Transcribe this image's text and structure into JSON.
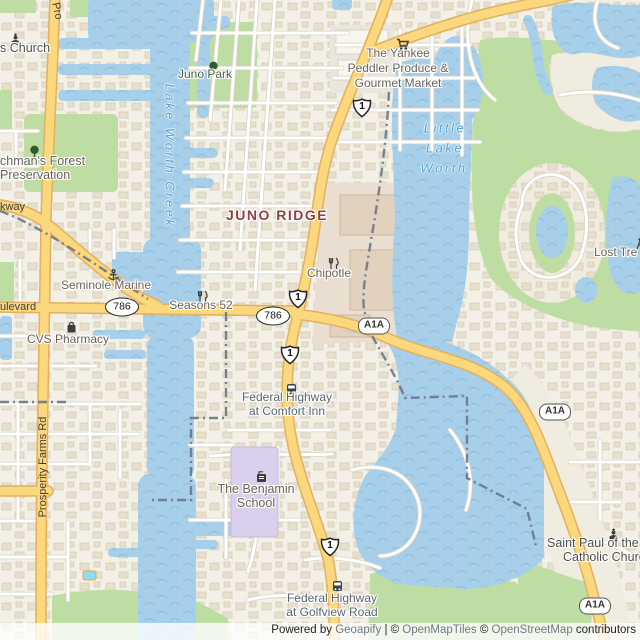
{
  "palette": {
    "land": "#f3f0e8",
    "residential_building": "#e6ddc9",
    "building_stroke": "#d2c7ae",
    "water": "#a8cfe9",
    "wave": "#90c1de",
    "green": "#bedda3",
    "road_main": "#fbd77d",
    "road_casing": "#e2b05e",
    "road_minor": "#ffffff",
    "road_minor_casing": "#d9d3c5",
    "boundary": "#6e7789",
    "district_label": "#8a4242",
    "water_label": "#4fa0cf",
    "poi_label": "#6b6157",
    "transit_label": "#5a646e",
    "road_label": "#3f3f3f",
    "school_fill": "#dad0eb",
    "commercial_fill": "#e9ded0",
    "plaza_fill": "#e9e6df",
    "attribution_link": "#6d7a85"
  },
  "routes": {
    "us1": "1",
    "sr786": "786",
    "a1a": "A1A"
  },
  "labels": {
    "s_church": "s Church",
    "juno_park": "Juno Park",
    "yankee1": "The Yankee",
    "yankee2": "Peddler Produce &",
    "yankee3": "Gourmet Market",
    "creek": "Lake Worth Creek",
    "little1": "Little",
    "little2": "Lake",
    "little3": "Worth",
    "forest1": "chman's Forest",
    "forest2": "Preservation",
    "parkway": "kway",
    "juno_ridge": "JUNO RIDGE",
    "lost_tree": "Lost Tre",
    "seminole": "Seminole Marine",
    "seasons": "Seasons 52",
    "boulevard": "ulevard",
    "cvs": "CVS Pharmacy",
    "chipotle": "Chipotle",
    "comfort1": "Federal Highway",
    "comfort2": "at Comfort Inn",
    "prosperity": "Prosperity Farms Rd",
    "prosperity_top": "Pro",
    "benjamin1": "The Benjamin",
    "benjamin2": "School",
    "stpaul1": "Saint Paul of the C",
    "stpaul2": "Catholic Churc",
    "golfview1": "Federal Highway",
    "golfview2": "at Golfview Road"
  },
  "attribution": {
    "powered_by": "Powered by ",
    "geoapify": "Geoapify",
    "sep": " | © ",
    "openmaptiles": "OpenMapTiles",
    "sep2": " © ",
    "openstreetmap": "OpenStreetMap",
    "contributors": " contributors"
  },
  "icons": {
    "church": "place-of-worship",
    "tree": "park-tree",
    "cart": "supermarket",
    "restaurant": "restaurant",
    "anchor": "marina",
    "bag": "pharmacy-shop",
    "bus": "bus-stop",
    "school": "school",
    "golf": "golf-course"
  }
}
